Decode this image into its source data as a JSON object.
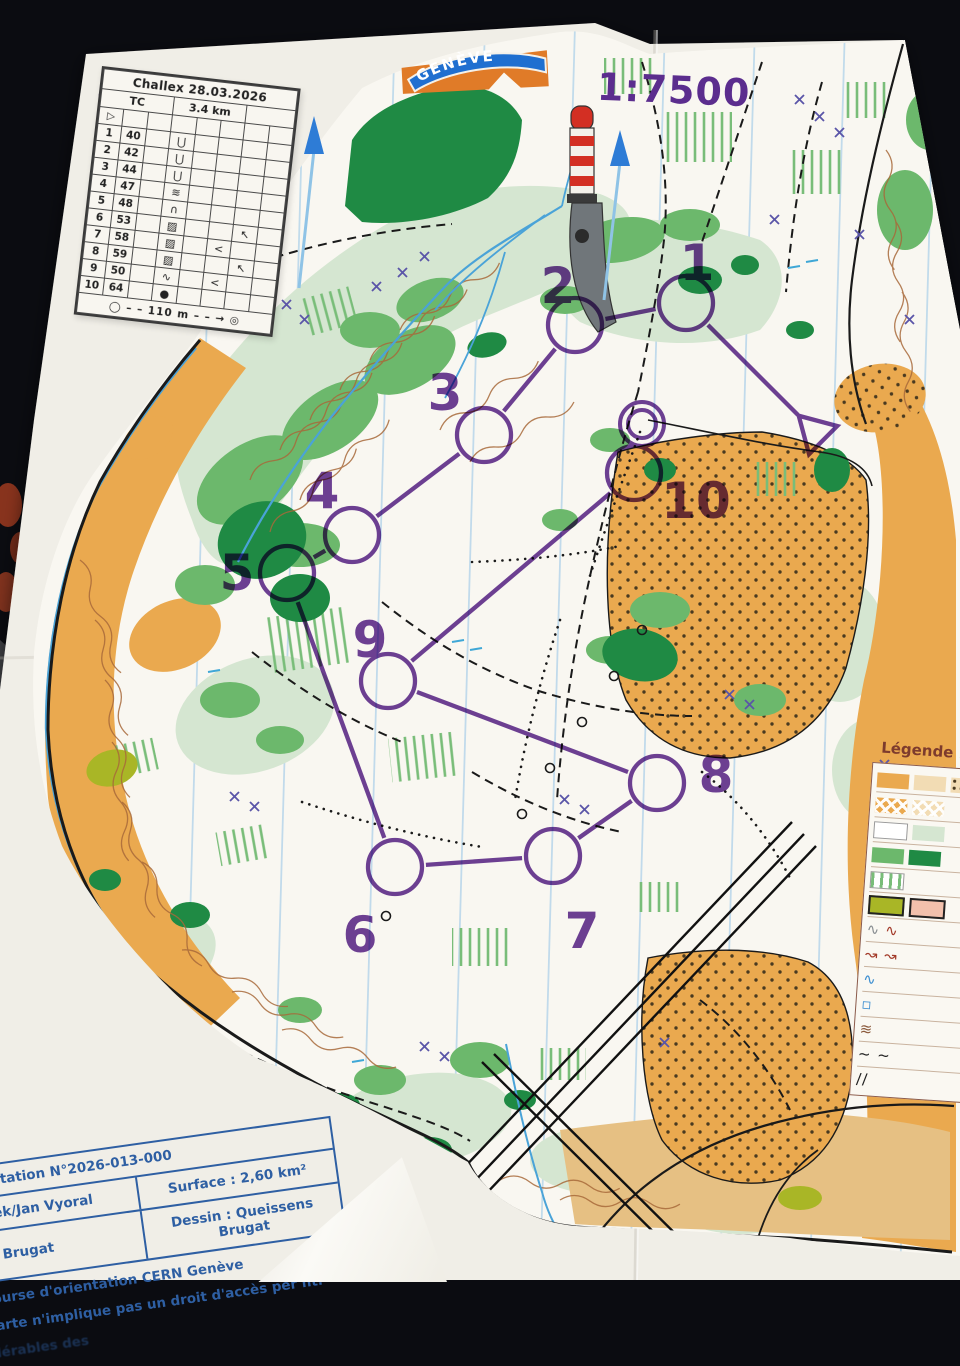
{
  "scale_label": "1:7500",
  "logo": {
    "club_text": "GENÈVE"
  },
  "control_card": {
    "title": "Challex 28.03.2026",
    "course_class": "TC",
    "length": "3.4 km",
    "climb": "",
    "start_symbol": "▷",
    "rows": [
      [
        "▷",
        "",
        "",
        "",
        "",
        "",
        "",
        ""
      ],
      [
        "1",
        "40",
        "",
        "⋃",
        "",
        "",
        "",
        ""
      ],
      [
        "2",
        "42",
        "",
        "⋃",
        "",
        "",
        "",
        ""
      ],
      [
        "3",
        "44",
        "",
        "⋃",
        "",
        "",
        "",
        ""
      ],
      [
        "4",
        "47",
        "",
        "≋",
        "",
        "",
        "",
        ""
      ],
      [
        "5",
        "48",
        "",
        "∩",
        "",
        "",
        "",
        ""
      ],
      [
        "6",
        "53",
        "",
        "▨",
        "",
        "",
        "↖",
        ""
      ],
      [
        "7",
        "58",
        "",
        "▨",
        "",
        "<",
        "",
        ""
      ],
      [
        "8",
        "59",
        "",
        "▨",
        "",
        "",
        "↖",
        ""
      ],
      [
        "9",
        "50",
        "",
        "∿",
        "",
        "<",
        "",
        ""
      ],
      [
        "10",
        "64",
        "",
        "●",
        "",
        "",
        "",
        ""
      ]
    ],
    "footer": {
      "start_glyph": "◯",
      "dashes": "– –",
      "distance": "110 m",
      "arrow": "→",
      "finish_glyph": "◎"
    }
  },
  "course": {
    "color": "#5e2b8f",
    "start": {
      "x": 815,
      "y": 432
    },
    "finish": {
      "x": 642,
      "y": 424
    },
    "controls": [
      {
        "n": "1",
        "x": 686,
        "y": 303,
        "lx": 697,
        "ly": 280
      },
      {
        "n": "2",
        "x": 575,
        "y": 325,
        "lx": 558,
        "ly": 303
      },
      {
        "n": "3",
        "x": 484,
        "y": 435,
        "lx": 445,
        "ly": 410
      },
      {
        "n": "4",
        "x": 352,
        "y": 535,
        "lx": 322,
        "ly": 508
      },
      {
        "n": "5",
        "x": 287,
        "y": 573,
        "lx": 237,
        "ly": 590
      },
      {
        "n": "6",
        "x": 395,
        "y": 867,
        "lx": 360,
        "ly": 952
      },
      {
        "n": "7",
        "x": 553,
        "y": 856,
        "lx": 582,
        "ly": 948
      },
      {
        "n": "8",
        "x": 657,
        "y": 783,
        "lx": 716,
        "ly": 792
      },
      {
        "n": "9",
        "x": 388,
        "y": 681,
        "lx": 370,
        "ly": 657
      },
      {
        "n": "10",
        "x": 634,
        "y": 473,
        "lx": 696,
        "ly": 518
      }
    ]
  },
  "legend": {
    "title": "Légende :",
    "rows": [
      [
        {
          "t": "b",
          "c": "#eaa94f"
        },
        {
          "t": "b",
          "c": "#f2dcb4"
        },
        {
          "t": "b",
          "c": "#f2dcb4",
          "p": "dots"
        }
      ],
      [
        {
          "t": "b",
          "c": "#eaa94f",
          "p": "check"
        },
        {
          "t": "b",
          "c": "#f2dcb4",
          "p": "check"
        }
      ],
      [
        {
          "t": "b",
          "c": "#ffffff"
        },
        {
          "t": "b",
          "c": "#d5e6d1"
        }
      ],
      [
        {
          "t": "b",
          "c": "#6cb86c"
        },
        {
          "t": "b",
          "c": "#1f8a44"
        }
      ],
      [
        {
          "t": "b",
          "c": "#ffffff",
          "p": "stripes"
        }
      ],
      [
        {
          "t": "b",
          "c": "#a9b626",
          "bd": 1
        },
        {
          "t": "b",
          "c": "#f2c0ac",
          "bd": 1
        }
      ],
      [
        {
          "t": "g",
          "g": "∿",
          "c": "#8a8f93"
        },
        {
          "t": "g",
          "g": "∿",
          "c": "#a33b2a"
        }
      ],
      [
        {
          "t": "g",
          "g": "↝ ↝",
          "c": "#a33b2a"
        }
      ],
      [
        {
          "t": "g",
          "g": "∿",
          "c": "#3d8fd1"
        }
      ],
      [
        {
          "t": "g",
          "g": "▫",
          "c": "#3d8fd1"
        }
      ],
      [
        {
          "t": "g",
          "g": "≋",
          "c": "#8b5a3c"
        }
      ],
      [
        {
          "t": "g",
          "g": "~ ~",
          "c": "#222222"
        }
      ],
      [
        {
          "t": "g",
          "g": "//",
          "c": "#222222"
        }
      ]
    ]
  },
  "info_table": {
    "rows": [
      {
        "type": "full",
        "text": "rientation N°2026-013-000"
      },
      {
        "type": "split",
        "left": "anek/Jan Vyoral",
        "right": "Surface : 2,60 km²"
      },
      {
        "type": "split",
        "left": "ns Brugat",
        "right": "Dessin : Queissens Brugat"
      },
      {
        "type": "free",
        "text": "course d'orientation CERN Genève"
      },
      {
        "type": "free",
        "text": "carte n'implique pas un droit d'accès per      nt."
      },
      {
        "type": "free",
        "text": "dérables des",
        "faint": true
      }
    ]
  }
}
